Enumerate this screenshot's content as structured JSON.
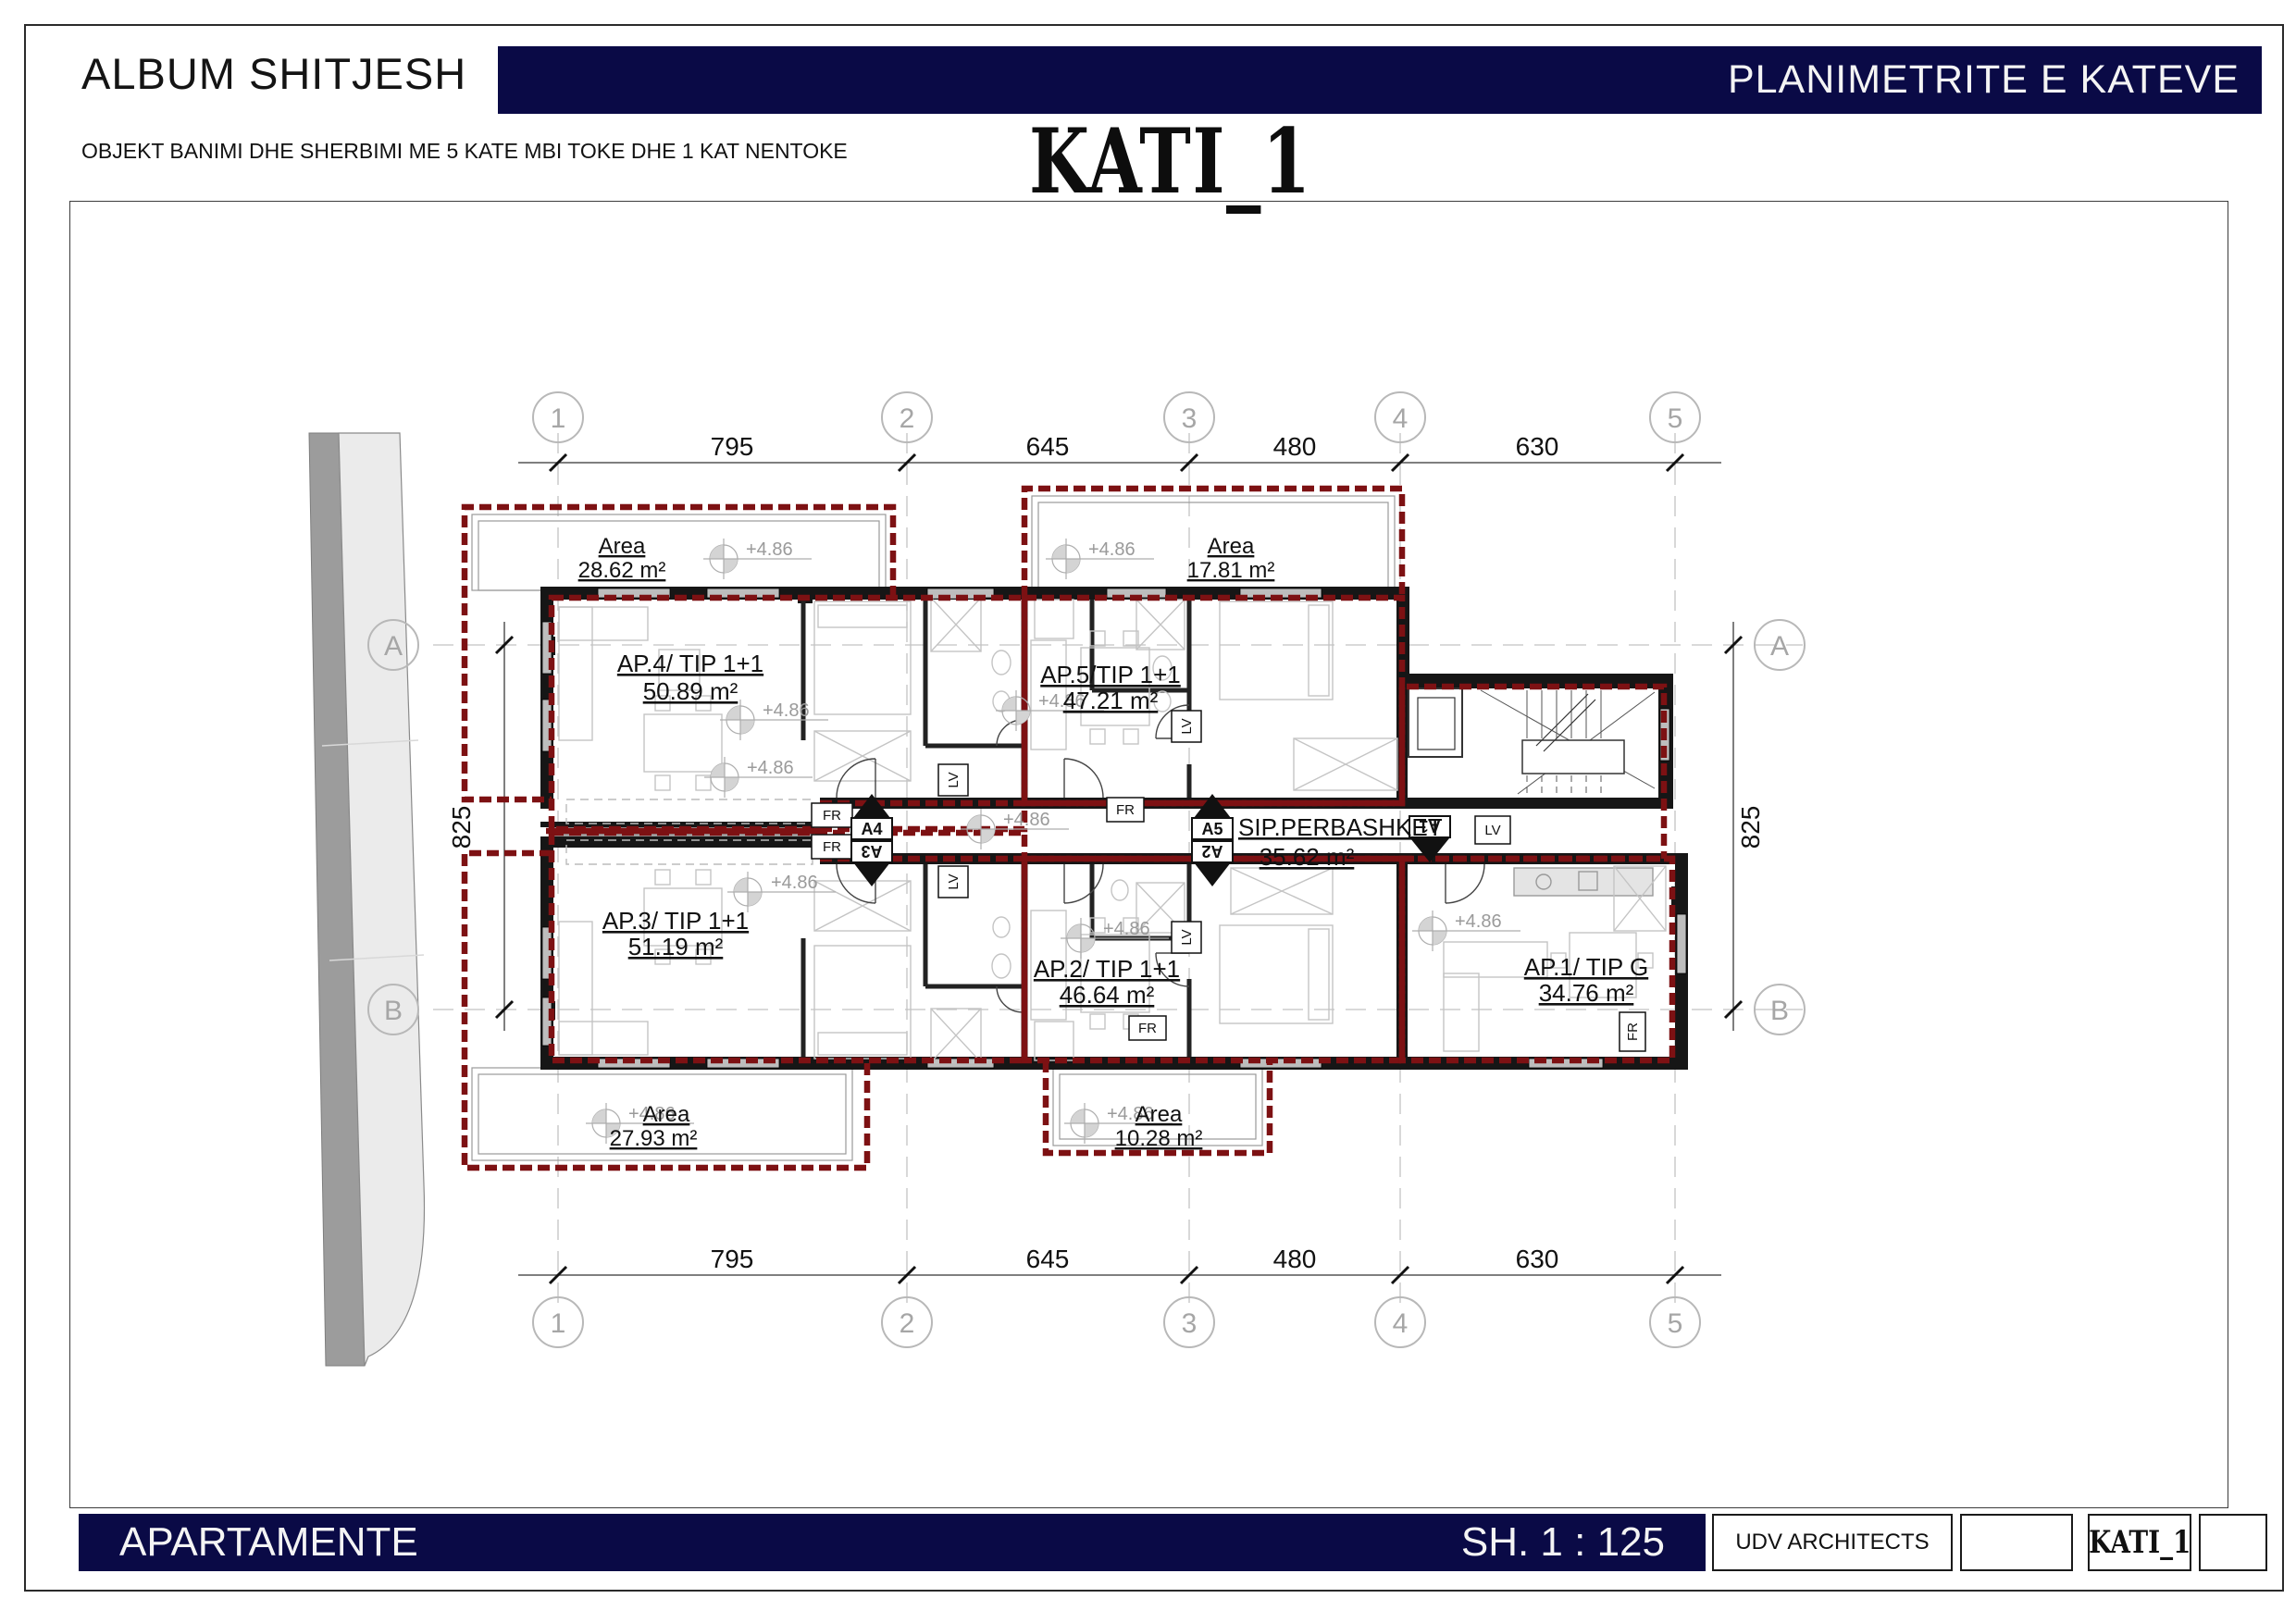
{
  "header": {
    "album_title": "ALBUM SHITJESH",
    "banner_title": "PLANIMETRITE E KATEVE",
    "subtitle": "OBJEKT BANIMI DHE SHERBIMI ME 5 KATE MBI TOKE DHE 1 KAT NENTOKE",
    "floor_title": "KATI_1"
  },
  "footer": {
    "section_label": "APARTAMENTE",
    "scale_label": "SH. 1 : 125",
    "architect": "UDV ARCHITECTS",
    "sheet_code": "KATI_1"
  },
  "plan": {
    "grid_cols": [
      "1",
      "2",
      "3",
      "4",
      "5"
    ],
    "grid_rows": [
      "A",
      "B"
    ],
    "dims_top": [
      "795",
      "645",
      "480",
      "630"
    ],
    "dims_bottom": [
      "795",
      "645",
      "480",
      "630"
    ],
    "dim_side": "825",
    "elevation": "+4.86",
    "apartments": [
      {
        "name": "AP.4/ TIP 1+1",
        "area": "50.89 m²"
      },
      {
        "name": "AP.5/TIP 1+1",
        "area": "47.21 m²"
      },
      {
        "name": "AP.3/ TIP 1+1",
        "area": "51.19 m²"
      },
      {
        "name": "AP.2/ TIP 1+1",
        "area": "46.64 m²"
      },
      {
        "name": "AP.1/ TIP G",
        "area": "34.76 m²"
      }
    ],
    "common_area": {
      "name": "SIP.PERBASHKET",
      "area": "35.62 m²"
    },
    "terraces": [
      {
        "label": "Area",
        "area": "28.62 m²"
      },
      {
        "label": "Area",
        "area": "17.81 m²"
      },
      {
        "label": "Area",
        "area": "27.93 m²"
      },
      {
        "label": "Area",
        "area": "10.28 m²"
      }
    ],
    "markers": {
      "a1": "A1",
      "a2": "A2",
      "a3": "A3",
      "a4": "A4",
      "a5": "A5"
    },
    "tags": {
      "lv": "LV",
      "fr": "FR"
    }
  },
  "colors": {
    "navy": "#0a0a46",
    "red_dash": "#7d1113",
    "wall_black": "#161616",
    "road_dark": "#9c9c9c",
    "road_light": "#ebebeb"
  }
}
